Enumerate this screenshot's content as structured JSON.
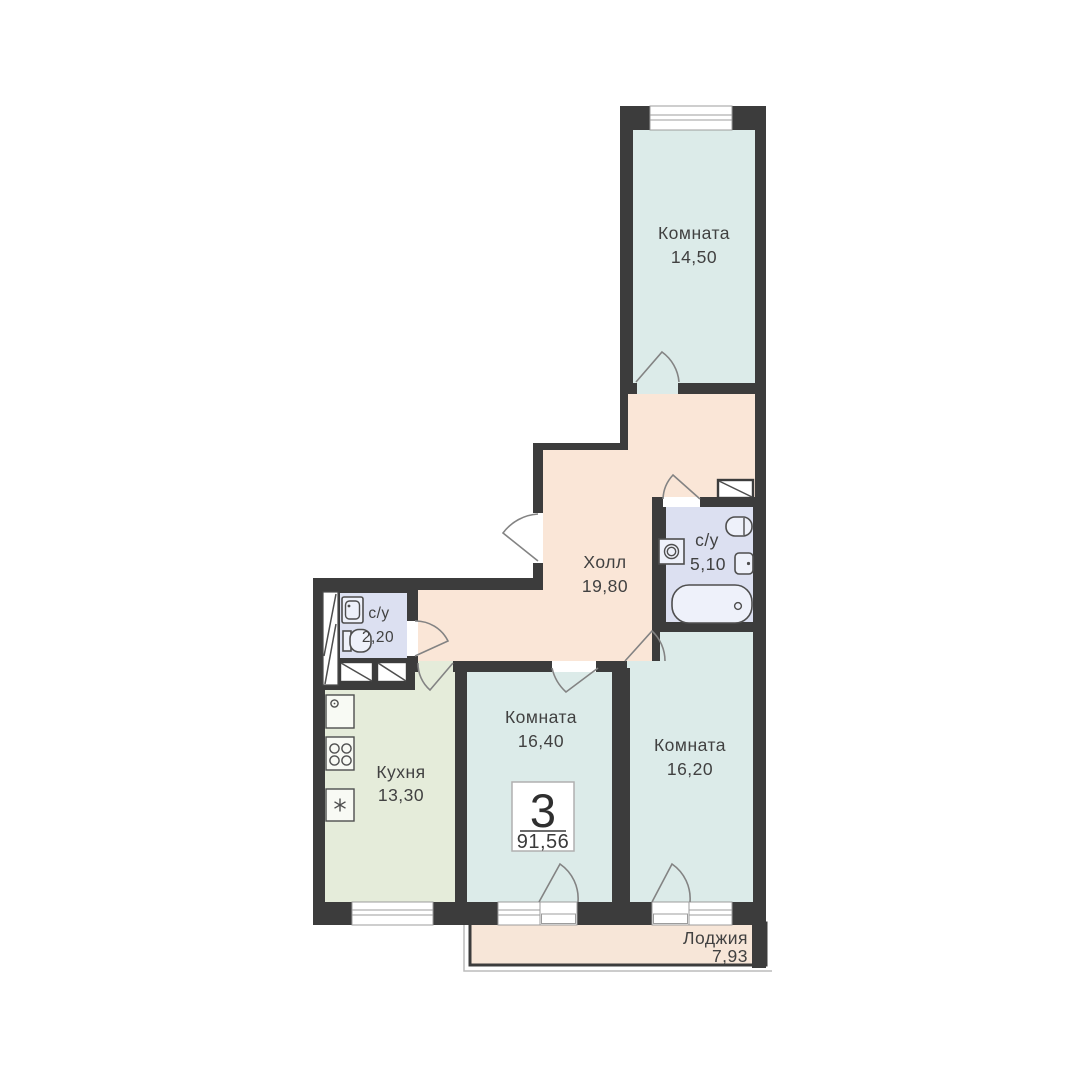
{
  "badge": {
    "number": "3",
    "total_area": "91,56"
  },
  "rooms": [
    {
      "name": "Комната",
      "area": "14,50"
    },
    {
      "name": "Холл",
      "area": "19,80"
    },
    {
      "name": "с/у",
      "area": "5,10"
    },
    {
      "name": "с/у",
      "area": "2,20"
    },
    {
      "name": "Кухня",
      "area": "13,30"
    },
    {
      "name": "Комната",
      "area": "16,40"
    },
    {
      "name": "Комната",
      "area": "16,20"
    },
    {
      "name": "Лоджия",
      "area": "7,93"
    }
  ],
  "colors": {
    "wall": "#3c3c3c",
    "room": "#dcebe9",
    "hall": "#fae6d7",
    "bathroom": "#dce0f1",
    "kitchen": "#e5ecda",
    "loggia": "#f7e6d8",
    "window": "#ffffff",
    "text": "#414141",
    "badge_border": "#b0b0b0"
  }
}
